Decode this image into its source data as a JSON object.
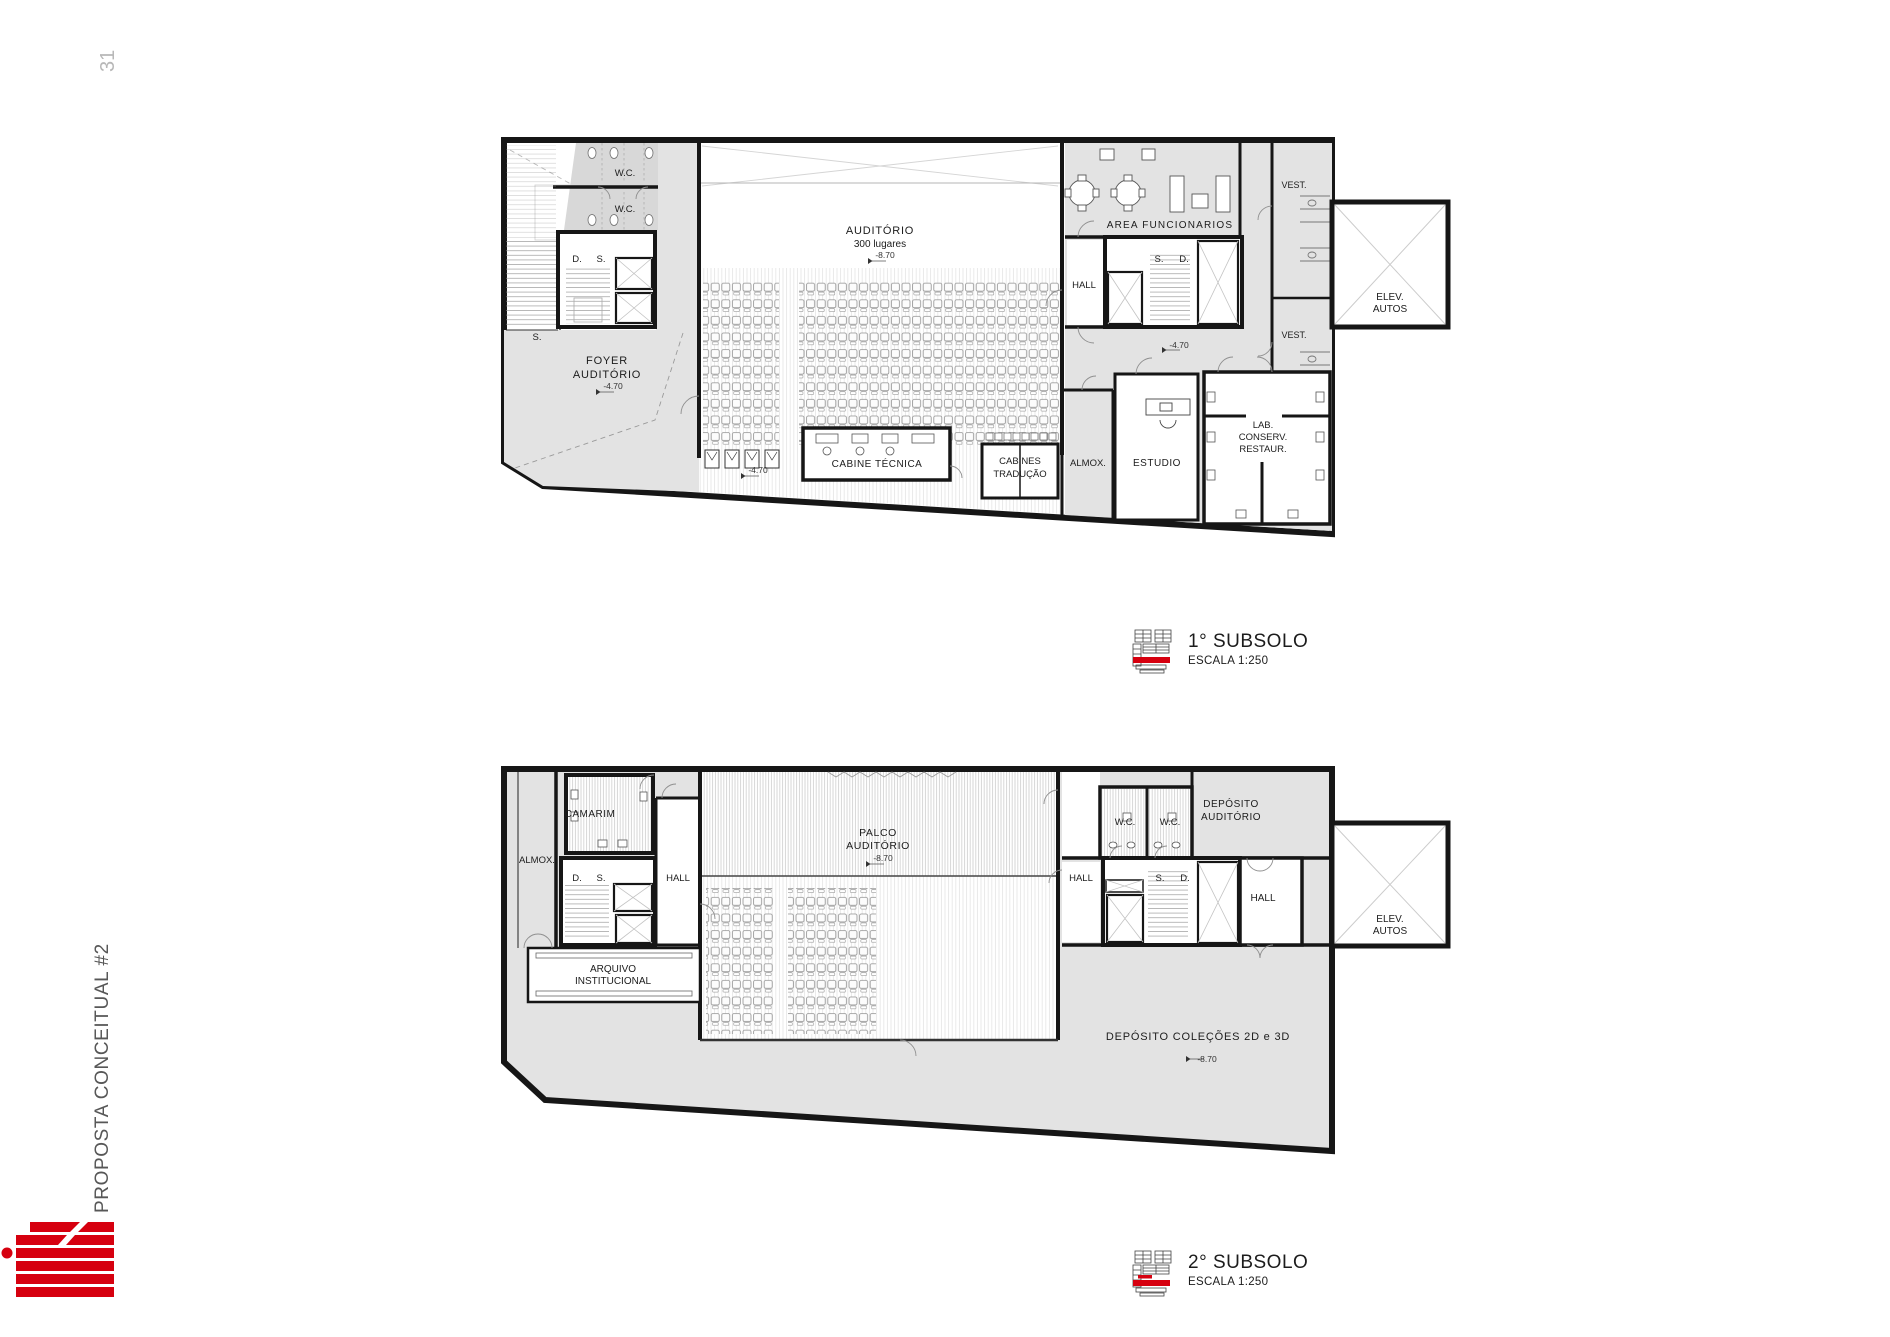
{
  "page": {
    "number": "31",
    "sidebar_title": "PROPOSTA CONCEITUAL #2"
  },
  "colors": {
    "accent_red": "#d6000f",
    "wall": "#161616",
    "fill_gray": "#e3e3e3",
    "label": "#1c1c1c"
  },
  "legend1": {
    "title": "1° SUBSOLO",
    "scale": "ESCALA 1:250"
  },
  "legend2": {
    "title": "2° SUBSOLO",
    "scale": "ESCALA 1:250"
  },
  "plan1": {
    "labels": {
      "wc_top": "W.C.",
      "wc_bottom": "W.C.",
      "d": "D.",
      "s": "S.",
      "s_foyer": "S.",
      "foyer1": "FOYER",
      "foyer2": "AUDITÓRIO",
      "foyer_level": "-4.70",
      "aud1": "AUDITÓRIO",
      "aud2": "300 lugares",
      "aud_level": "-8.70",
      "cabine": "CABINE TÉCNICA",
      "cab1": "CABINES",
      "cab2": "TRADUÇÃO",
      "floor_level": "-4.70",
      "almox": "ALMOX.",
      "estudio": "ESTUDIO",
      "lab1": "LAB.",
      "lab2": "CONSERV.",
      "lab3": "RESTAUR.",
      "area_func": "AREA FUNCIONARIOS",
      "hall": "HALL",
      "core_s": "S.",
      "core_d": "D.",
      "core_level": "-4.70",
      "vest_top": "VEST.",
      "vest_bottom": "VEST.",
      "elev1": "ELEV.",
      "elev2": "AUTOS"
    }
  },
  "plan2": {
    "labels": {
      "almox": "ALMOX.",
      "camarim": "CAMARIM",
      "d": "D.",
      "s": "S.",
      "hall_left": "HALL",
      "arq1": "ARQUIVO",
      "arq2": "INSTITUCIONAL",
      "palco1": "PALCO",
      "palco2": "AUDITÓRIO",
      "palco_level": "-8.70",
      "wc_left": "W.C.",
      "wc_right": "W.C.",
      "hall_mid": "HALL",
      "core_s": "S.",
      "core_d": "D.",
      "dep1": "DEPÓSITO",
      "dep2": "AUDITÓRIO",
      "hall_right": "HALL",
      "elev1": "ELEV.",
      "elev2": "AUTOS",
      "colecoes": "DEPÓSITO COLEÇÕES 2D e 3D",
      "colecoes_level": "-8.70"
    }
  }
}
